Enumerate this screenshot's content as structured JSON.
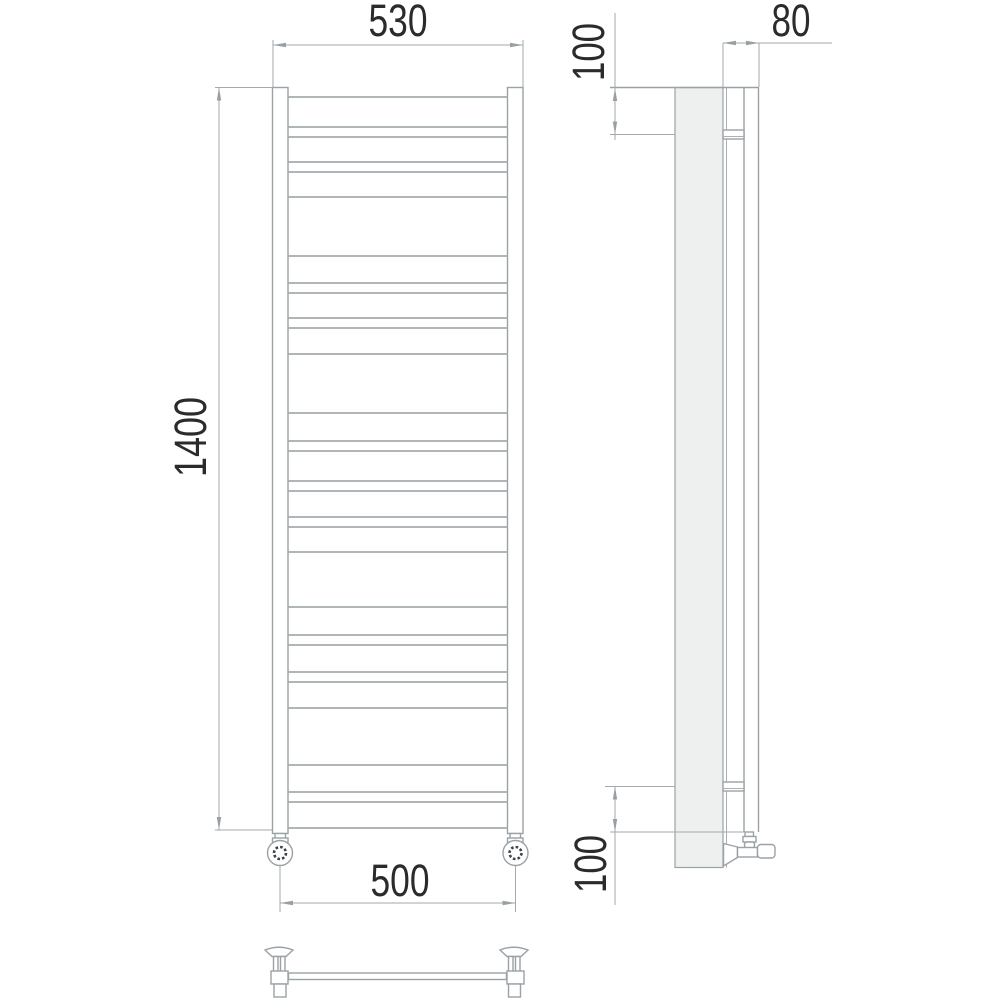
{
  "title": "Heated towel rail technical drawing",
  "dimensions": {
    "front_width_top": "530",
    "front_height": "1400",
    "front_width_bottom": "500",
    "side_depth": "80",
    "side_top_offset": "100",
    "side_bottom_offset": "100"
  },
  "colors": {
    "background": "#ffffff",
    "outline": "#9aa2a6",
    "panel_fill": "#eef0f0",
    "dimension_text": "#2b2b2b"
  },
  "drawing": {
    "front_view": {
      "rung_y": [
        97,
        127,
        137,
        162,
        172,
        197,
        256,
        283,
        293,
        318,
        328,
        354,
        413,
        441,
        451,
        481,
        491,
        517,
        527,
        552,
        607,
        635,
        645,
        672,
        682,
        708,
        765,
        792,
        802,
        828
      ]
    }
  }
}
